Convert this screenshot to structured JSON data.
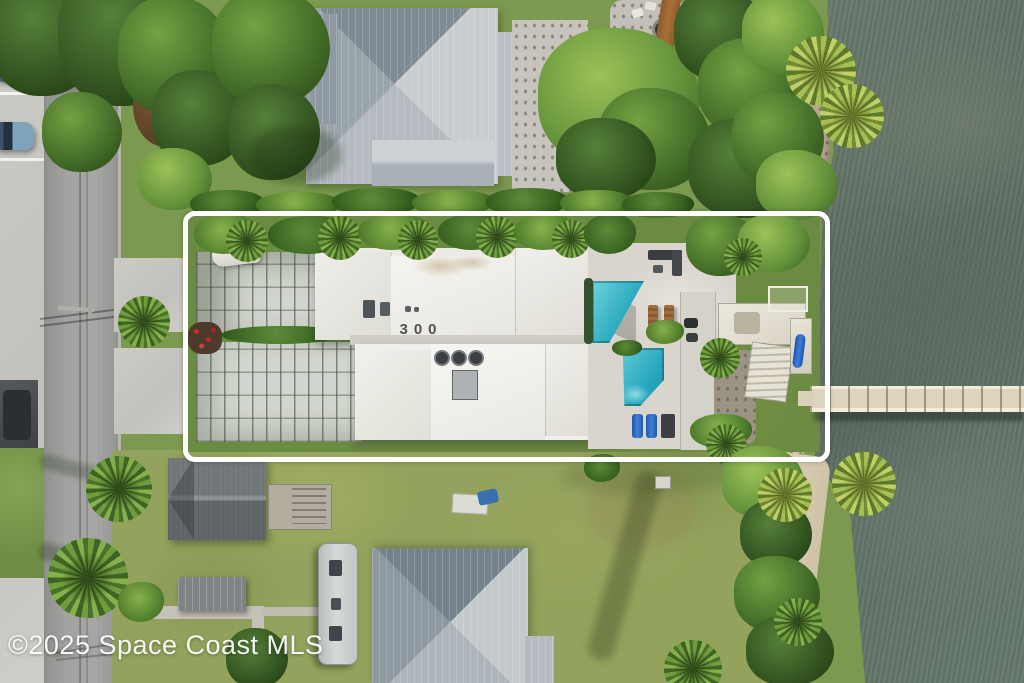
{
  "image": {
    "kind": "aerial-real-estate-photo",
    "width": 1024,
    "height": 683
  },
  "watermark": {
    "text": "©2025 Space Coast MLS"
  },
  "property": {
    "roof_number": "300",
    "boundary_color": "#ffffff"
  },
  "colors": {
    "water": "#68766a",
    "pool": "#2fb3c9",
    "lawn": "#93a25c",
    "asphalt": "#9b9b99",
    "concrete": "#c9c8c2",
    "metal_roof": "#aeb6bc",
    "flat_white_roof": "#f2f1ec",
    "paver_driveway": "#d2d5cd",
    "sand_beach": "#d6cbb4",
    "tree_dark": "#3e6322",
    "tree_light": "#85b14c",
    "dock": "#ddd5c0",
    "boat_cover": "#2b3340",
    "kayak": "#2b6fd6"
  }
}
